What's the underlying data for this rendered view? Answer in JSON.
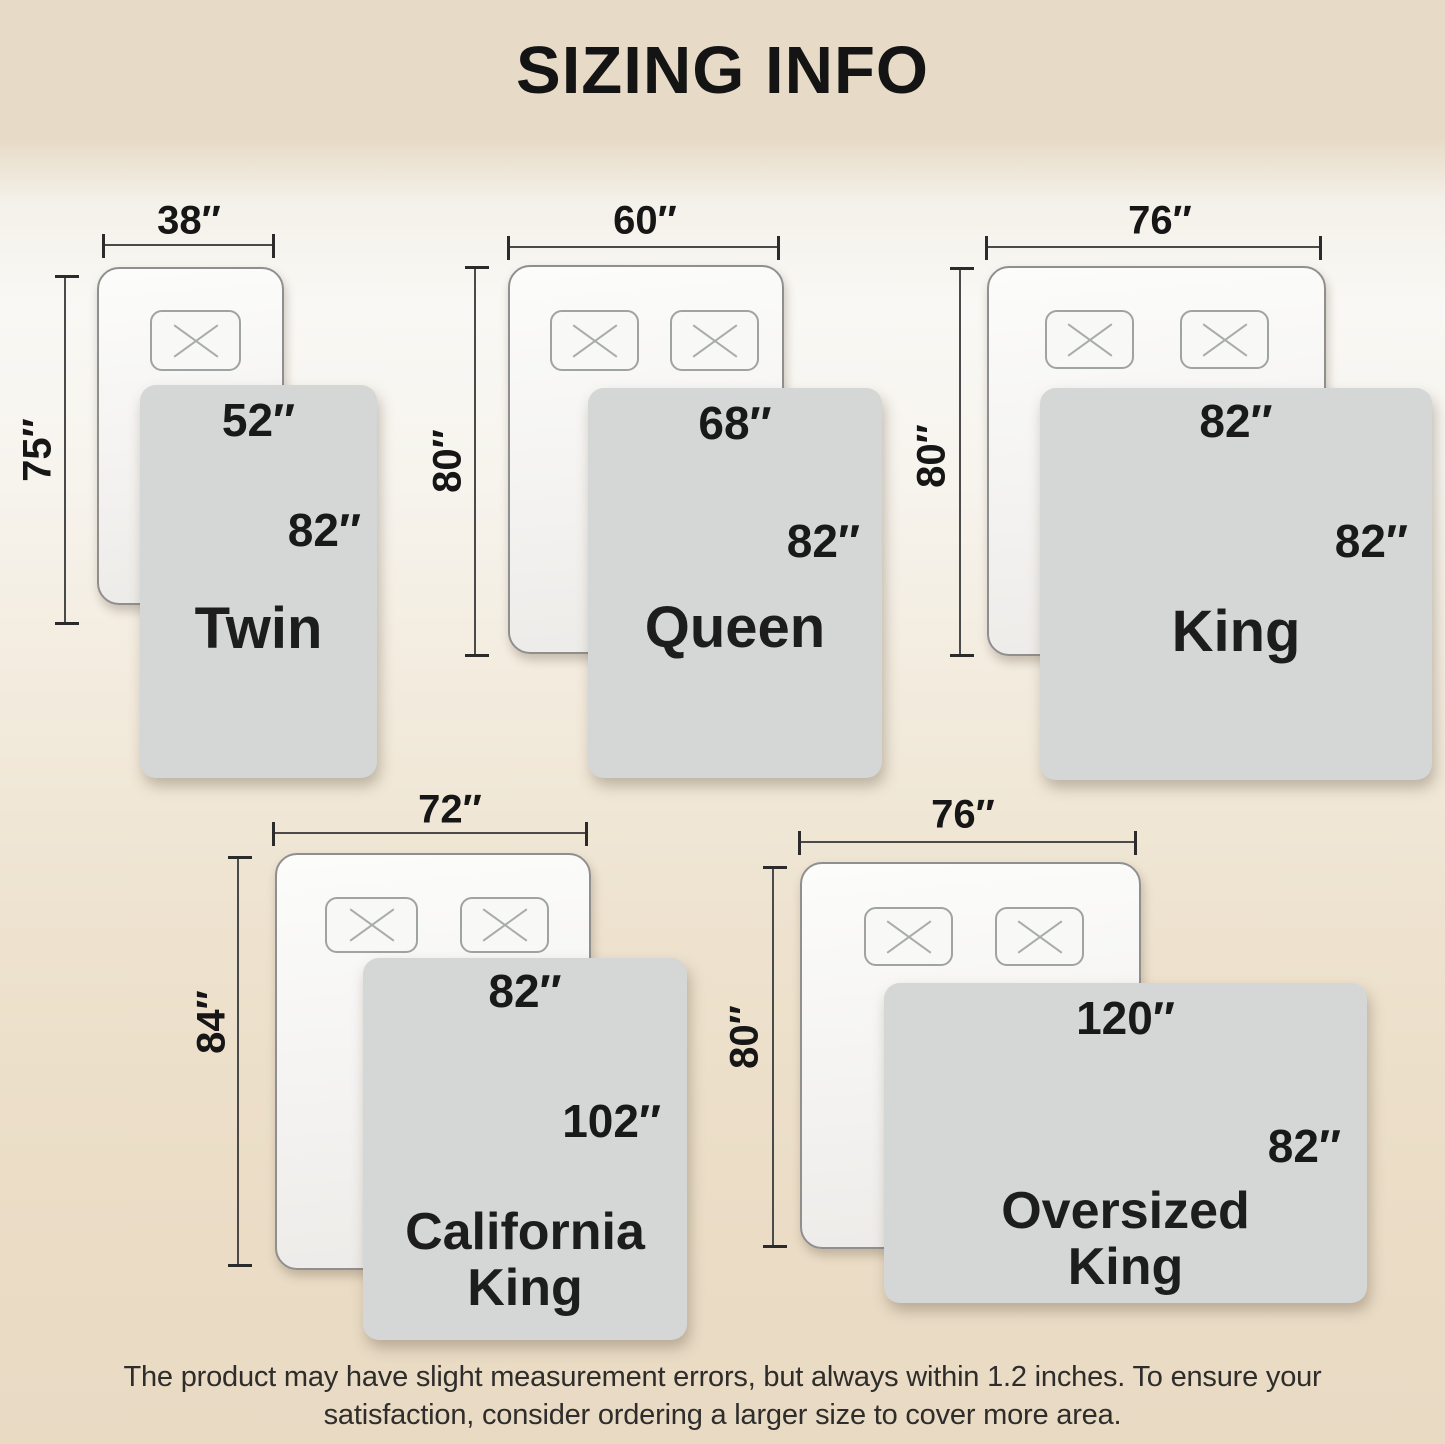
{
  "title": "SIZING INFO",
  "sizes": [
    {
      "id": "twin",
      "name_lines": [
        "Twin"
      ],
      "mattress": {
        "width": "38″",
        "height": "75″"
      },
      "blanket": {
        "width": "52″",
        "height": "82″"
      },
      "pillows": 1
    },
    {
      "id": "queen",
      "name_lines": [
        "Queen"
      ],
      "mattress": {
        "width": "60″",
        "height": "80″"
      },
      "blanket": {
        "width": "68″",
        "height": "82″"
      },
      "pillows": 2
    },
    {
      "id": "king",
      "name_lines": [
        "King"
      ],
      "mattress": {
        "width": "76″",
        "height": "80″"
      },
      "blanket": {
        "width": "82″",
        "height": "82″"
      },
      "pillows": 2
    },
    {
      "id": "california-king",
      "name_lines": [
        "California",
        "King"
      ],
      "mattress": {
        "width": "72″",
        "height": "84″"
      },
      "blanket": {
        "width": "82″",
        "height": "102″"
      },
      "pillows": 2
    },
    {
      "id": "oversized-king",
      "name_lines": [
        "Oversized",
        "King"
      ],
      "mattress": {
        "width": "76″",
        "height": "80″"
      },
      "blanket": {
        "width": "120″",
        "height": "82″"
      },
      "pillows": 2
    }
  ],
  "footer": {
    "line1": "The product may have slight measurement errors, but always within 1.2 inches. To ensure your",
    "line2": "satisfaction, consider ordering a larger size to cover more area."
  },
  "colors": {
    "band_beige": "#e7dbc7",
    "background_light": "#f9f8f4",
    "blanket_gray": "#d5d6d6",
    "mattress_white": "#f8f8f7",
    "line_dark": "#4a4a4a",
    "text_black": "#161616"
  }
}
